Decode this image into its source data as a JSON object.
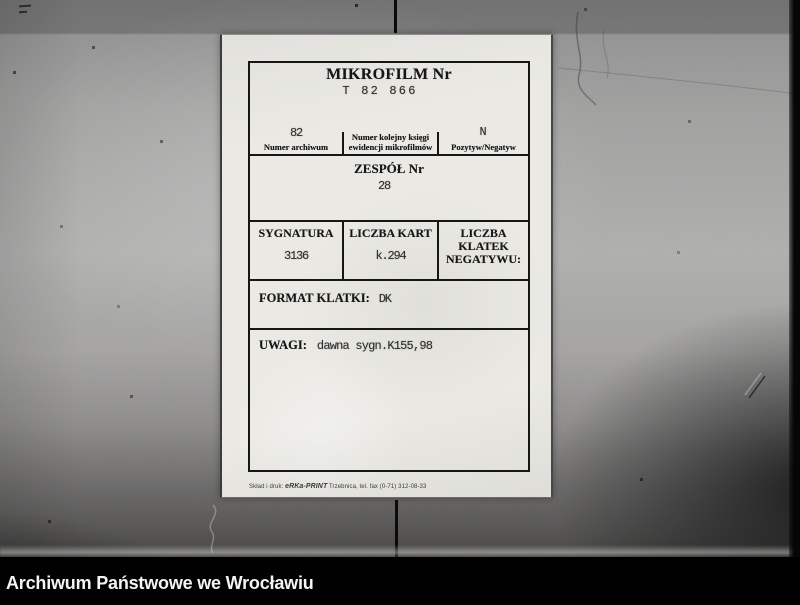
{
  "card": {
    "title": "MIKROFILM Nr",
    "microfilm_number": "T 82 866",
    "archive_row": {
      "archive_number": {
        "value": "82",
        "label": "Numer archiwum"
      },
      "register": {
        "label_line1": "Numer kolejny księgi",
        "label_line2": "ewidencji mikrofilmów"
      },
      "positive_negative": {
        "value": "N",
        "label": "Pozytyw/Negatyw"
      }
    },
    "zespol": {
      "label": "ZESPÓŁ Nr",
      "value": "28"
    },
    "details": {
      "sygnatura": {
        "label": "SYGNATURA",
        "value": "3136"
      },
      "liczba_kart": {
        "label": "LICZBA KART",
        "value": "k.294"
      },
      "liczba_klatek": {
        "label_line1": "LICZBA KLATEK",
        "label_line2": "NEGATYWU:",
        "value": ""
      }
    },
    "format_klatki": {
      "label": "FORMAT KLATKI:",
      "value": "DK"
    },
    "uwagi": {
      "label": "UWAGI:",
      "value": "dawna sygn.K155,98"
    },
    "printer_note": {
      "prefix": "Skład i druk: ",
      "brand": "eRKa-PRINT",
      "details": " Trzebnica, tel. fax (0-71) 312-08-33"
    }
  },
  "footer": {
    "archive_name": "Archiwum Państwowe we Wrocławiu"
  },
  "colors": {
    "paper": "#eae9e4",
    "ink": "#161616",
    "typed_ink": "#2e2e2e",
    "footer_bg": "#010101",
    "footer_text": "#f4f4f4"
  }
}
